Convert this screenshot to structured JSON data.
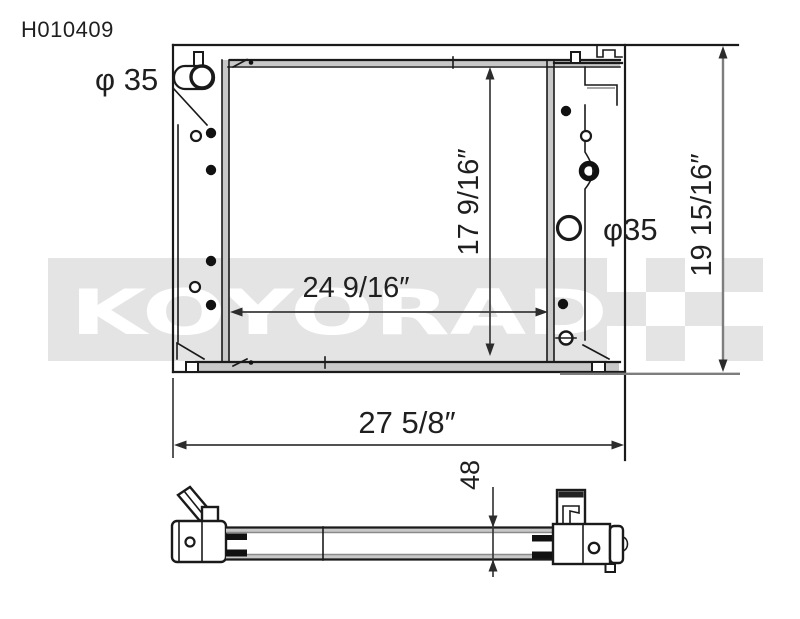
{
  "page": {
    "background": "#ffffff"
  },
  "part_number": "H010409",
  "watermark": {
    "text": "KOYORAD",
    "band_color": "#e4e4e4",
    "letter_color": "#ffffff"
  },
  "labels": {
    "inlet_diameter": "φ 35",
    "outlet_diameter": "φ35"
  },
  "dimensions": {
    "core_width": "24 9/16″",
    "core_height": "17 9/16″",
    "overall_width": "27 5/8″",
    "overall_height": "19 15/16″",
    "core_thickness": "48"
  },
  "colors": {
    "line": "#1a1a1a",
    "dimension": "#3a3a3a",
    "watermark_band": "#e4e4e4",
    "shading": "#c8c8c8"
  }
}
